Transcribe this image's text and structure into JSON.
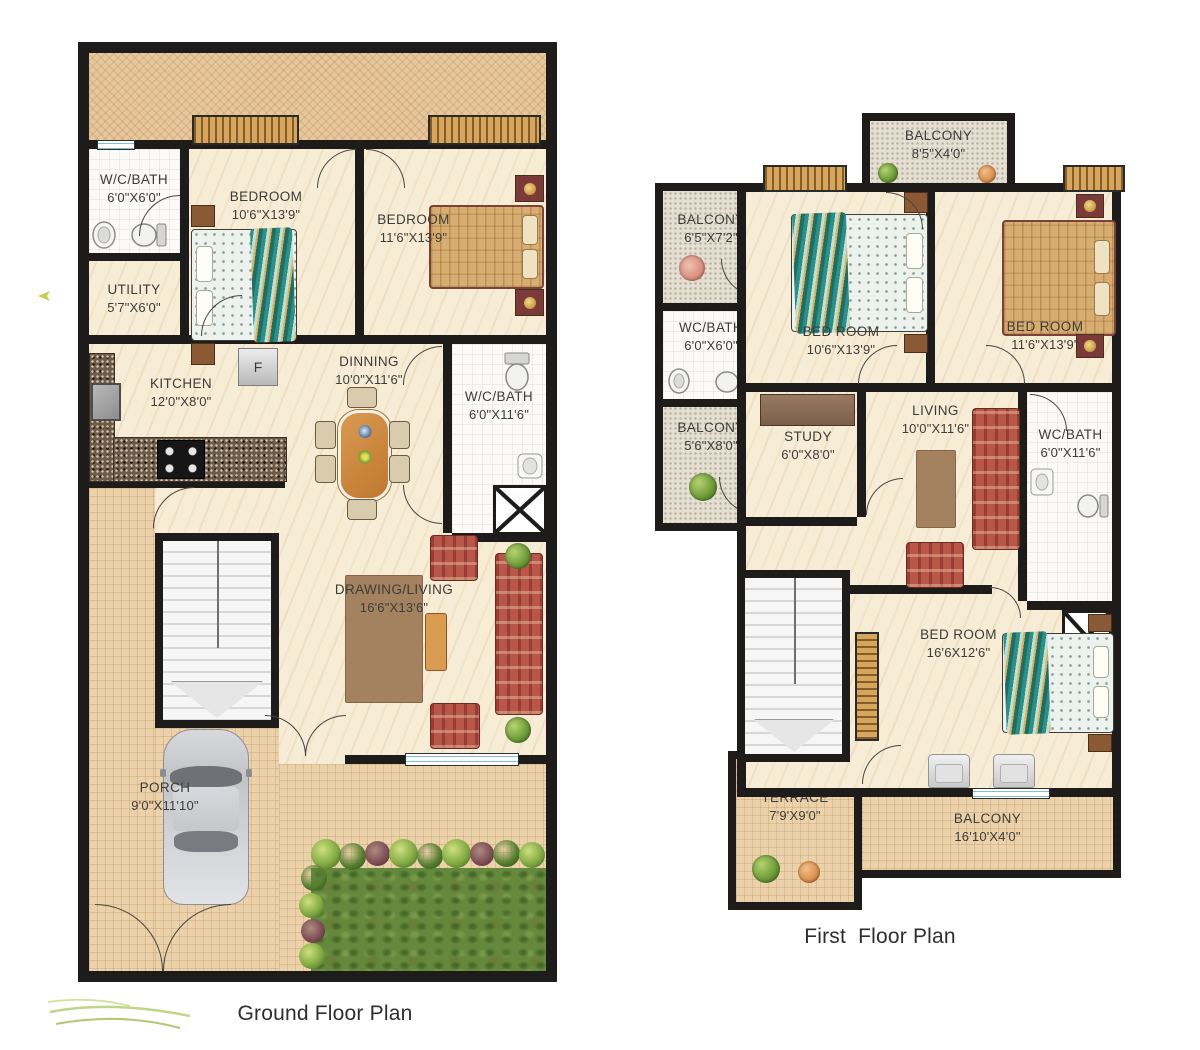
{
  "ground": {
    "title": "Ground Floor Plan",
    "fridge_label": "F",
    "rooms": {
      "wcbath1": {
        "name": "W/C/BATH",
        "dims": "6'0\"X6'0\""
      },
      "utility": {
        "name": "UTILITY",
        "dims": "5'7\"X6'0\""
      },
      "bedroom1": {
        "name": "BEDROOM",
        "dims": "10'6\"X13'9\""
      },
      "bedroom2": {
        "name": "BEDROOM",
        "dims": "11'6\"X13'9\""
      },
      "kitchen": {
        "name": "KITCHEN",
        "dims": "12'0\"X8'0\""
      },
      "dinning": {
        "name": "DINNING",
        "dims": "10'0\"X11'6\""
      },
      "wcbath2": {
        "name": "W/C/BATH",
        "dims": "6'0\"X11'6\""
      },
      "drawing_living": {
        "name": "DRAWING/LIVING",
        "dims": "16'6\"X13'6\""
      },
      "porch": {
        "name": "PORCH",
        "dims": "9'0\"X11'10\""
      }
    }
  },
  "first": {
    "title": "First  Floor Plan",
    "rooms": {
      "balcony_top": {
        "name": "BALCONY",
        "dims": "8'5\"X4'0\""
      },
      "balcony_left1": {
        "name": "BALCONY",
        "dims": "6'5\"X7'2\""
      },
      "wcbath1": {
        "name": "WC/BATH",
        "dims": "6'0\"X6'0\""
      },
      "balcony_left2": {
        "name": "BALCONY",
        "dims": "5'6\"X8'0\""
      },
      "bedroom1": {
        "name": "BED ROOM",
        "dims": "10'6\"X13'9\""
      },
      "bedroom2": {
        "name": "BED ROOM",
        "dims": "11'6\"X13'9\""
      },
      "study": {
        "name": "STUDY",
        "dims": "6'0\"X8'0\""
      },
      "living": {
        "name": "LIVING",
        "dims": "10'0\"X11'6\""
      },
      "wcbath2": {
        "name": "WC/BATH",
        "dims": "6'0\"X11'6\""
      },
      "bedroom3": {
        "name": "BED ROOM",
        "dims": "16'6X12'6\""
      },
      "terrace": {
        "name": "TERRACE",
        "dims": "7'9'X9'0\""
      },
      "balcony_bottom": {
        "name": "BALCONY",
        "dims": "16'10'X4'0\""
      }
    }
  },
  "colors": {
    "wall": "#1d1c1a",
    "floor_cream": "#f7ecd5",
    "outdoor_tile": "#ecd2ab",
    "balcony_floor": "#e5dfd2",
    "outdoor_band": "#e8c79c",
    "grass": "#64883c",
    "sofa_red": "#b8564a",
    "table_wood": "#cf8a41",
    "window_hatch": "#d8a55c",
    "bed_teal": "#2e8f85",
    "bed_tan": "#d8ad72"
  }
}
